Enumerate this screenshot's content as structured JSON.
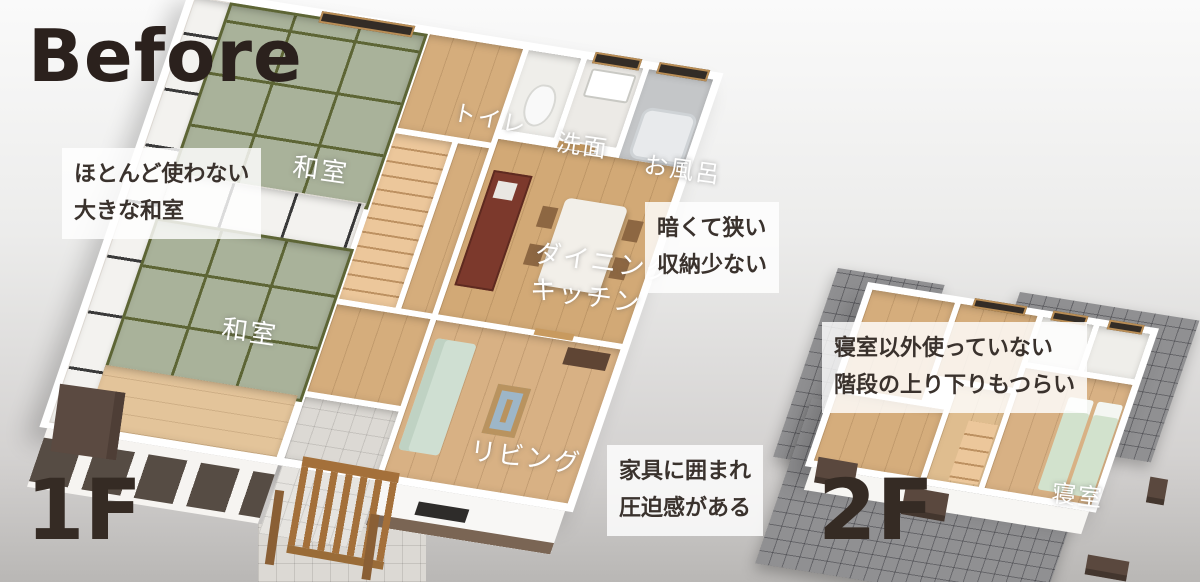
{
  "title": "Before",
  "floor_labels": {
    "first": "1F",
    "second": "2F"
  },
  "rooms": {
    "washitsu_upper": "和室",
    "washitsu_lower": "和室",
    "toilet": "トイレ",
    "washroom": "洗面",
    "bath": "お風呂",
    "dining_kitchen_line1": "ダイニング",
    "dining_kitchen_line2": "キッチン",
    "living": "リビング",
    "bedroom": "寝室"
  },
  "annotations": [
    {
      "line1": "ほとんど使わない",
      "line2": "大きな和室"
    },
    {
      "line1": "暗くて狭い",
      "line2": "収納少ない"
    },
    {
      "line1": "家具に囲まれ",
      "line2": "圧迫感がある"
    },
    {
      "line1": "寝室以外使っていない",
      "line2": "階段の上り下りもつらい"
    }
  ],
  "colors": {
    "title_text": "#2b211d",
    "floor_label_text": "#352b24",
    "annotation_text": "#3a322d",
    "room_label_text": "#ffffff",
    "tatami": "#a9b29a",
    "tatami_edge": "#5d6535",
    "wood_floor": "#d5ad7c",
    "roof": "#909092",
    "wall": "#ffffff"
  }
}
